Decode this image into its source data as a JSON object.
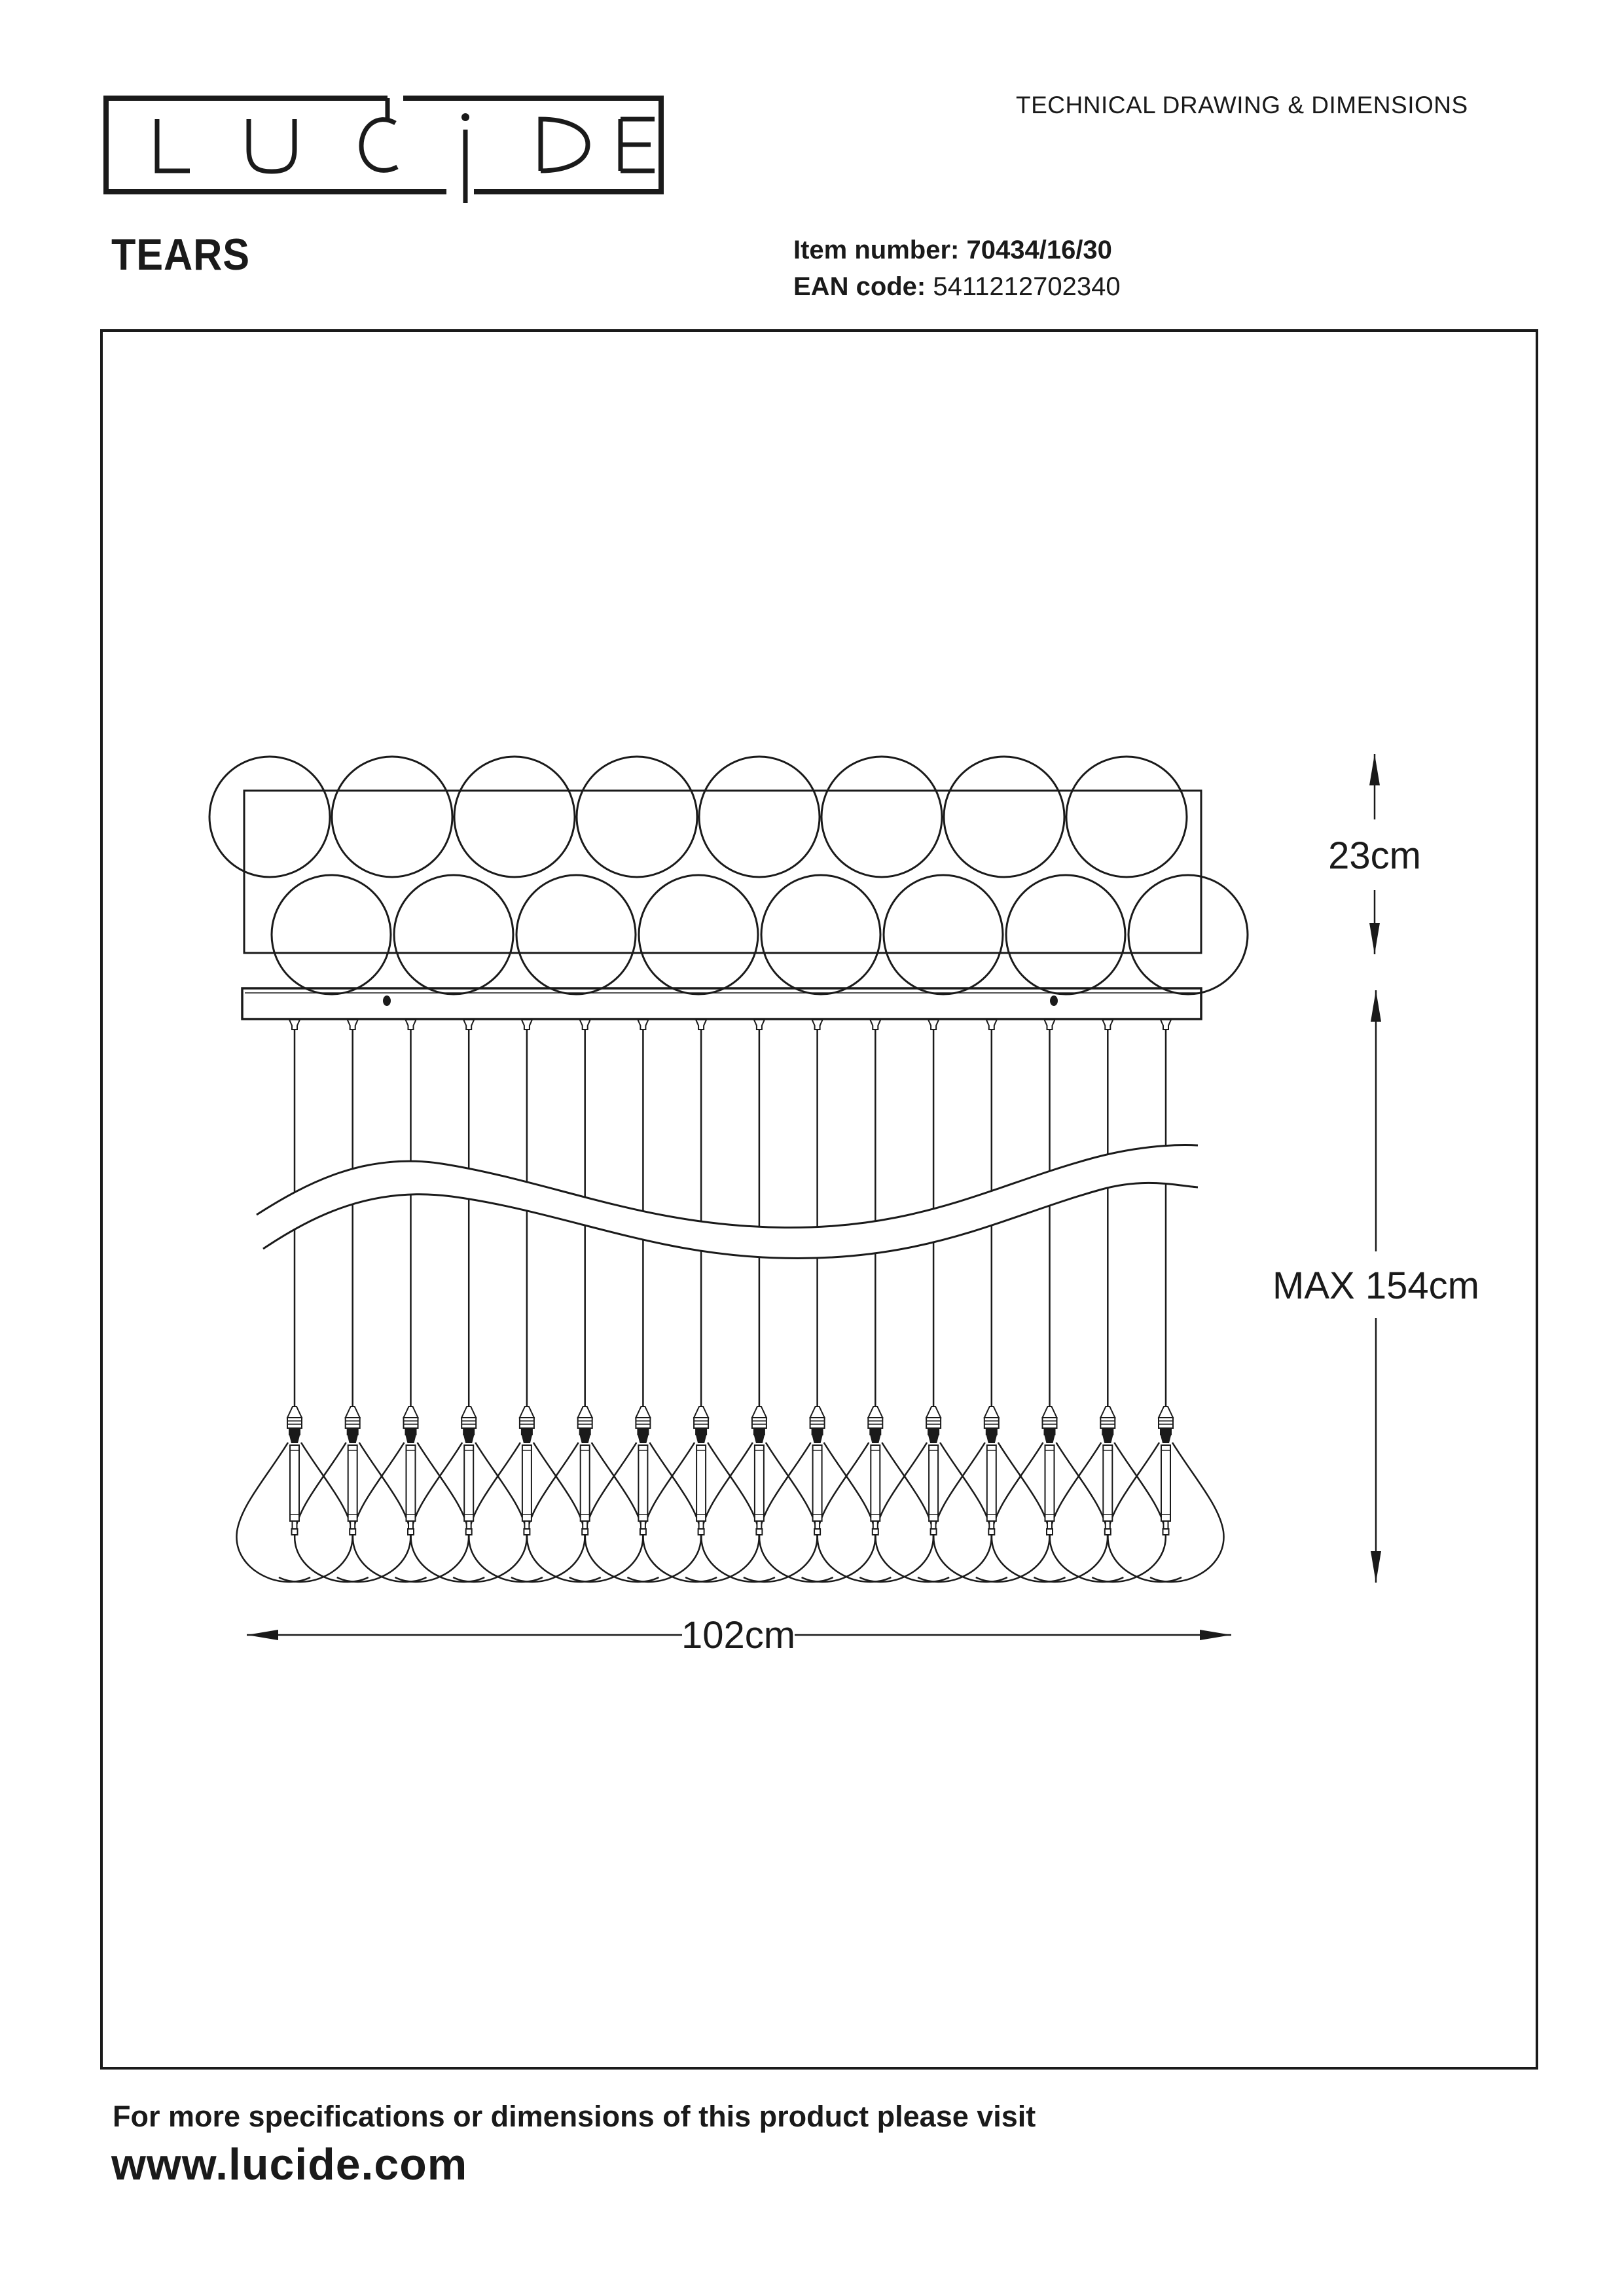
{
  "header": {
    "logo_text": "LUCIDE",
    "doc_title": "TECHNICAL DRAWING & DIMENSIONS",
    "product_name": "TEARS",
    "item_number_label": "Item number:",
    "item_number_value": "70434/16/30",
    "ean_label": "EAN code:",
    "ean_value": "5411212702340"
  },
  "drawing": {
    "dimensions": {
      "depth": "23cm",
      "max_height": "MAX 154cm",
      "width": "102cm"
    },
    "pendant_count": 16,
    "top_view": {
      "circles_per_row": 8,
      "rows": 2
    }
  },
  "footer": {
    "line1": "For more specifications or dimensions of this product please visit",
    "line2": "www.lucide.com"
  },
  "colors": {
    "ink": "#1a1a1a",
    "background": "#ffffff"
  }
}
